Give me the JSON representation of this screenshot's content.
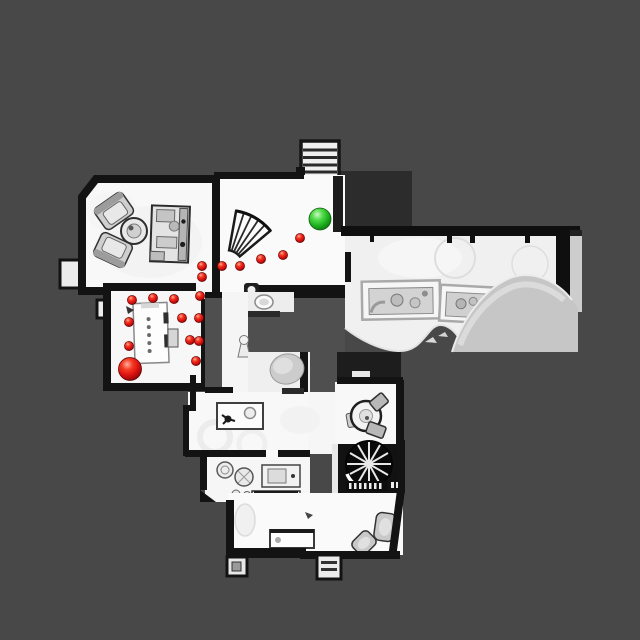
{
  "canvas": {
    "width": 640,
    "height": 640,
    "background_color": "#484848"
  },
  "palette": {
    "floor": "#f8f8f8",
    "wall": "#131313",
    "unscanned_interior": "#4f4f4f",
    "mesh_mound": "#c6c6c6",
    "goal_green": "#2bbf2b",
    "path_red": "#d81010"
  },
  "markers": {
    "goal": {
      "x": 320,
      "y": 219,
      "r": 11,
      "color": "#2bbf2b"
    },
    "agent": {
      "x": 130,
      "y": 369,
      "r": 11.5,
      "color": "#d81010"
    },
    "waypoint_radius": 4.6,
    "waypoint_color": "#d81010",
    "waypoints": [
      [
        300,
        238
      ],
      [
        283,
        255
      ],
      [
        261,
        259
      ],
      [
        240,
        266
      ],
      [
        222,
        266
      ],
      [
        202,
        266
      ],
      [
        202,
        277
      ],
      [
        200,
        296
      ],
      [
        174,
        299
      ],
      [
        153,
        298
      ],
      [
        132,
        300
      ],
      [
        182,
        318
      ],
      [
        199,
        318
      ],
      [
        129,
        322
      ],
      [
        190,
        340
      ],
      [
        199,
        341
      ],
      [
        129,
        346
      ],
      [
        196,
        361
      ]
    ]
  }
}
